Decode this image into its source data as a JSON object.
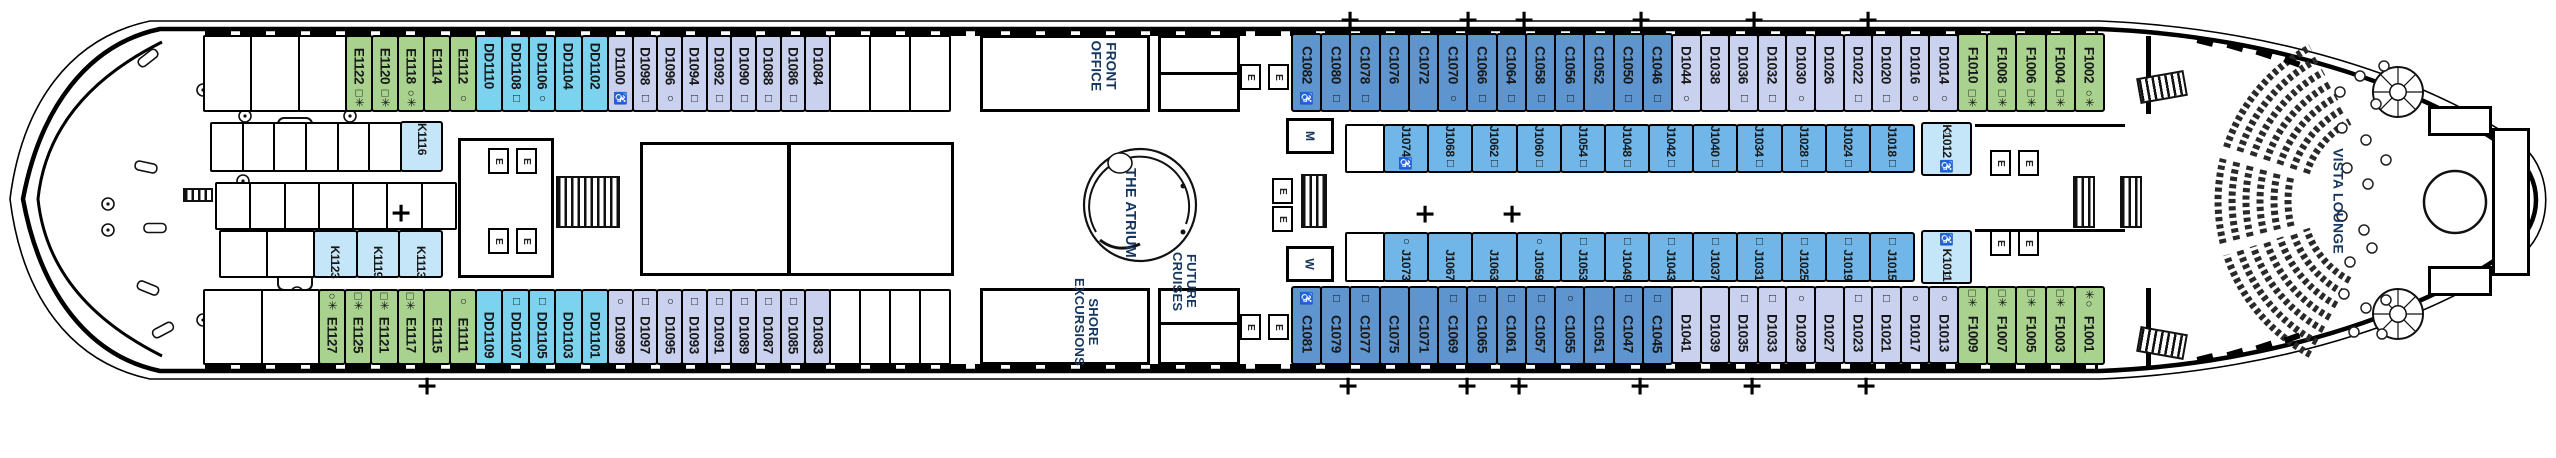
{
  "venues": {
    "front_office": "FRONT OFFICE",
    "shore_excursions": "SHORE EXCURSIONS",
    "future_cruises": "FUTURE CRUISES",
    "atrium": "THE ATRIUM",
    "vista_lounge": "VISTA LOUNGE"
  },
  "markers": {
    "elevator": "E",
    "mens": "M",
    "womens": "W",
    "plus": "+"
  },
  "colors": {
    "green": "#a9d28f",
    "cyan": "#7bd3f0",
    "lavender": "#c9d1ee",
    "c_blue": "#5e95cf",
    "j_blue": "#70b6e9",
    "k_blue": "#c5e5f8"
  },
  "cabin_groups": {
    "e_top": {
      "color": "green",
      "cabins": [
        {
          "n": "E1122",
          "s": "□✳"
        },
        {
          "n": "E1120",
          "s": "□✳"
        },
        {
          "n": "E1118",
          "s": "○✳"
        },
        {
          "n": "E1114"
        },
        {
          "n": "E1112",
          "s": "○"
        }
      ]
    },
    "dd_top": {
      "color": "cyan",
      "cabins": [
        {
          "n": "DD1110"
        },
        {
          "n": "DD1108",
          "s": "□"
        },
        {
          "n": "DD1106",
          "s": "○"
        },
        {
          "n": "DD1104"
        },
        {
          "n": "DD1102"
        }
      ]
    },
    "d_top_fwd": {
      "color": "lavender",
      "cabins": [
        {
          "n": "D1100",
          "s": "♿"
        },
        {
          "n": "D1098",
          "s": "□"
        },
        {
          "n": "D1096",
          "s": "○"
        },
        {
          "n": "D1094",
          "s": "□"
        },
        {
          "n": "D1092",
          "s": "□"
        },
        {
          "n": "D1090",
          "s": "□"
        },
        {
          "n": "D1088",
          "s": "□"
        },
        {
          "n": "D1086",
          "s": "□"
        },
        {
          "n": "D1084"
        }
      ]
    },
    "c_top": {
      "color": "c_blue",
      "cabins": [
        {
          "n": "C1082",
          "s": "♿"
        },
        {
          "n": "C1080",
          "s": "□"
        },
        {
          "n": "C1078",
          "s": "□"
        },
        {
          "n": "C1076"
        },
        {
          "n": "C1072"
        },
        {
          "n": "C1070",
          "s": "○"
        },
        {
          "n": "C1066",
          "s": "□"
        },
        {
          "n": "C1064",
          "s": "□"
        },
        {
          "n": "C1058",
          "s": "□"
        },
        {
          "n": "C1056",
          "s": "□"
        },
        {
          "n": "C1052"
        },
        {
          "n": "C1050",
          "s": "□"
        },
        {
          "n": "C1046",
          "s": "□"
        }
      ]
    },
    "d_top_aft": {
      "color": "lavender",
      "cabins": [
        {
          "n": "D1044",
          "s": "○"
        },
        {
          "n": "D1038"
        },
        {
          "n": "D1036",
          "s": "□"
        },
        {
          "n": "D1032",
          "s": "□"
        },
        {
          "n": "D1030",
          "s": "○"
        },
        {
          "n": "D1026"
        },
        {
          "n": "D1022",
          "s": "□"
        },
        {
          "n": "D1020",
          "s": "□"
        },
        {
          "n": "D1016",
          "s": "○"
        },
        {
          "n": "D1014",
          "s": "○"
        }
      ]
    },
    "f_top": {
      "color": "green",
      "cabins": [
        {
          "n": "F1010",
          "s": "□✳"
        },
        {
          "n": "F1008",
          "s": "□✳"
        },
        {
          "n": "F1006",
          "s": "□✳"
        },
        {
          "n": "F1004",
          "s": "□✳"
        },
        {
          "n": "F1002",
          "s": "○✳"
        }
      ]
    },
    "e_bot": {
      "color": "green",
      "cabins": [
        {
          "n": "E1127",
          "s": "○✳"
        },
        {
          "n": "E1125",
          "s": "□✳"
        },
        {
          "n": "E1121",
          "s": "□✳"
        },
        {
          "n": "E1117",
          "s": "□✳"
        },
        {
          "n": "E1115"
        },
        {
          "n": "E1111",
          "s": "○"
        }
      ]
    },
    "dd_bot": {
      "color": "cyan",
      "cabins": [
        {
          "n": "DD1109"
        },
        {
          "n": "DD1107",
          "s": "□"
        },
        {
          "n": "DD1105",
          "s": "□"
        },
        {
          "n": "DD1103"
        },
        {
          "n": "DD1101"
        }
      ]
    },
    "d_bot_fwd": {
      "color": "lavender",
      "cabins": [
        {
          "n": "D1099",
          "s": "○"
        },
        {
          "n": "D1097",
          "s": "□"
        },
        {
          "n": "D1095",
          "s": "○"
        },
        {
          "n": "D1093",
          "s": "□"
        },
        {
          "n": "D1091",
          "s": "□"
        },
        {
          "n": "D1089",
          "s": "□"
        },
        {
          "n": "D1087",
          "s": "□"
        },
        {
          "n": "D1085",
          "s": "□"
        },
        {
          "n": "D1083"
        }
      ]
    },
    "c_bot": {
      "color": "c_blue",
      "cabins": [
        {
          "n": "C1081",
          "s": "♿"
        },
        {
          "n": "C1079",
          "s": "□"
        },
        {
          "n": "C1077",
          "s": "□"
        },
        {
          "n": "C1075"
        },
        {
          "n": "C1071"
        },
        {
          "n": "C1069",
          "s": "□"
        },
        {
          "n": "C1065",
          "s": "□"
        },
        {
          "n": "C1061",
          "s": "□"
        },
        {
          "n": "C1057",
          "s": "□"
        },
        {
          "n": "C1055",
          "s": "○"
        },
        {
          "n": "C1051"
        },
        {
          "n": "C1047",
          "s": "□"
        },
        {
          "n": "C1045",
          "s": "□"
        }
      ]
    },
    "d_bot_aft": {
      "color": "lavender",
      "cabins": [
        {
          "n": "D1041"
        },
        {
          "n": "D1039"
        },
        {
          "n": "D1035",
          "s": "□"
        },
        {
          "n": "D1033",
          "s": "□"
        },
        {
          "n": "D1029",
          "s": "○"
        },
        {
          "n": "D1027"
        },
        {
          "n": "D1023",
          "s": "□"
        },
        {
          "n": "D1021",
          "s": "□"
        },
        {
          "n": "D1017",
          "s": "○"
        },
        {
          "n": "D1013",
          "s": "○"
        }
      ]
    },
    "f_bot": {
      "color": "green",
      "cabins": [
        {
          "n": "F1009",
          "s": "□✳"
        },
        {
          "n": "F1007",
          "s": "□✳"
        },
        {
          "n": "F1005",
          "s": "□✳"
        },
        {
          "n": "F1003",
          "s": "□✳"
        },
        {
          "n": "F1001",
          "s": "✳○"
        }
      ]
    },
    "k1116": {
      "color": "k_blue",
      "cabins": [
        {
          "n": "K1116"
        }
      ]
    },
    "k_mid": {
      "color": "k_blue",
      "cabins": [
        {
          "n": "K1123"
        },
        {
          "n": "K1119"
        },
        {
          "n": "K1113"
        }
      ]
    },
    "j_top": {
      "color": "j_blue",
      "cabins": [
        {
          "n": "J1074",
          "s": "♿"
        },
        {
          "n": "J1068",
          "s": "□"
        },
        {
          "n": "J1062",
          "s": "□"
        },
        {
          "n": "J1060",
          "s": "□"
        },
        {
          "n": "J1054",
          "s": "□"
        },
        {
          "n": "J1048",
          "s": "□"
        },
        {
          "n": "J1042",
          "s": "□"
        },
        {
          "n": "J1040",
          "s": "□"
        },
        {
          "n": "J1034",
          "s": "□"
        },
        {
          "n": "J1028",
          "s": "□"
        },
        {
          "n": "J1024",
          "s": "□"
        },
        {
          "n": "J1018",
          "s": "□"
        }
      ]
    },
    "k1012": {
      "color": "k_blue",
      "cabins": [
        {
          "n": "K1012",
          "s": "♿",
          "s2": "○"
        }
      ]
    },
    "j_bot": {
      "color": "j_blue",
      "cabins": [
        {
          "n": "J1073",
          "s": "○"
        },
        {
          "n": "J1067"
        },
        {
          "n": "J1063"
        },
        {
          "n": "J1059",
          "s": "○"
        },
        {
          "n": "J1053",
          "s": "□"
        },
        {
          "n": "J1049",
          "s": "□"
        },
        {
          "n": "J1043",
          "s": "□"
        },
        {
          "n": "J1037",
          "s": "□"
        },
        {
          "n": "J1031",
          "s": "□"
        },
        {
          "n": "J1025",
          "s": "□"
        },
        {
          "n": "J1019",
          "s": "□"
        },
        {
          "n": "J1015",
          "s": "□"
        }
      ]
    },
    "k1011": {
      "color": "k_blue",
      "cabins": [
        {
          "n": "K1011",
          "s": "♿",
          "s2": "○"
        }
      ]
    }
  }
}
